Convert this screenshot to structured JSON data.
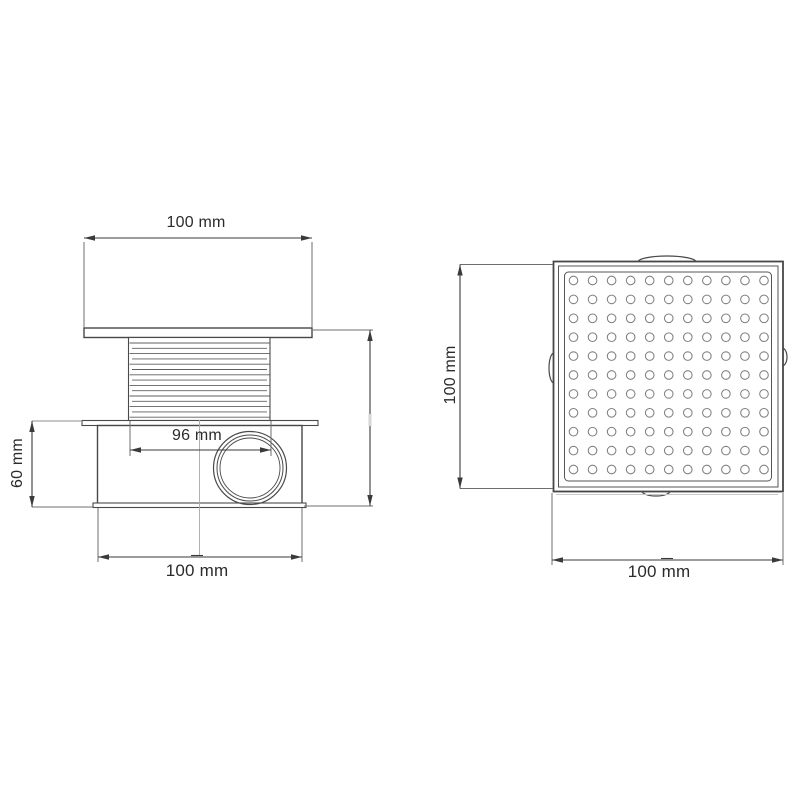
{
  "page": {
    "background": "#ffffff"
  },
  "drawing": {
    "type": "technical-drawing",
    "subject": "square floor drain with perforated grate, side view and top view",
    "stroke_color": "#474747",
    "dim_color": "#3a3a3a",
    "views": {
      "side": {
        "name": "side-view",
        "dimensions": {
          "top_width": "100 mm",
          "thread_width": "96 mm",
          "body_height": "60 mm",
          "bottom_width": "100 mm"
        },
        "threads": {
          "lines": 15,
          "start_y": 343,
          "step": 5.3,
          "x1": 129.5,
          "x2": 269.5
        }
      },
      "top": {
        "name": "top-view",
        "dimensions": {
          "side_height": "100 mm",
          "side_width": "100 mm"
        },
        "holes": {
          "rows": 11,
          "cols": 11,
          "start_x": 573.5,
          "start_y": 280.5,
          "step_x": 19.05,
          "step_y": 18.9,
          "radius": 4.3
        }
      }
    }
  }
}
